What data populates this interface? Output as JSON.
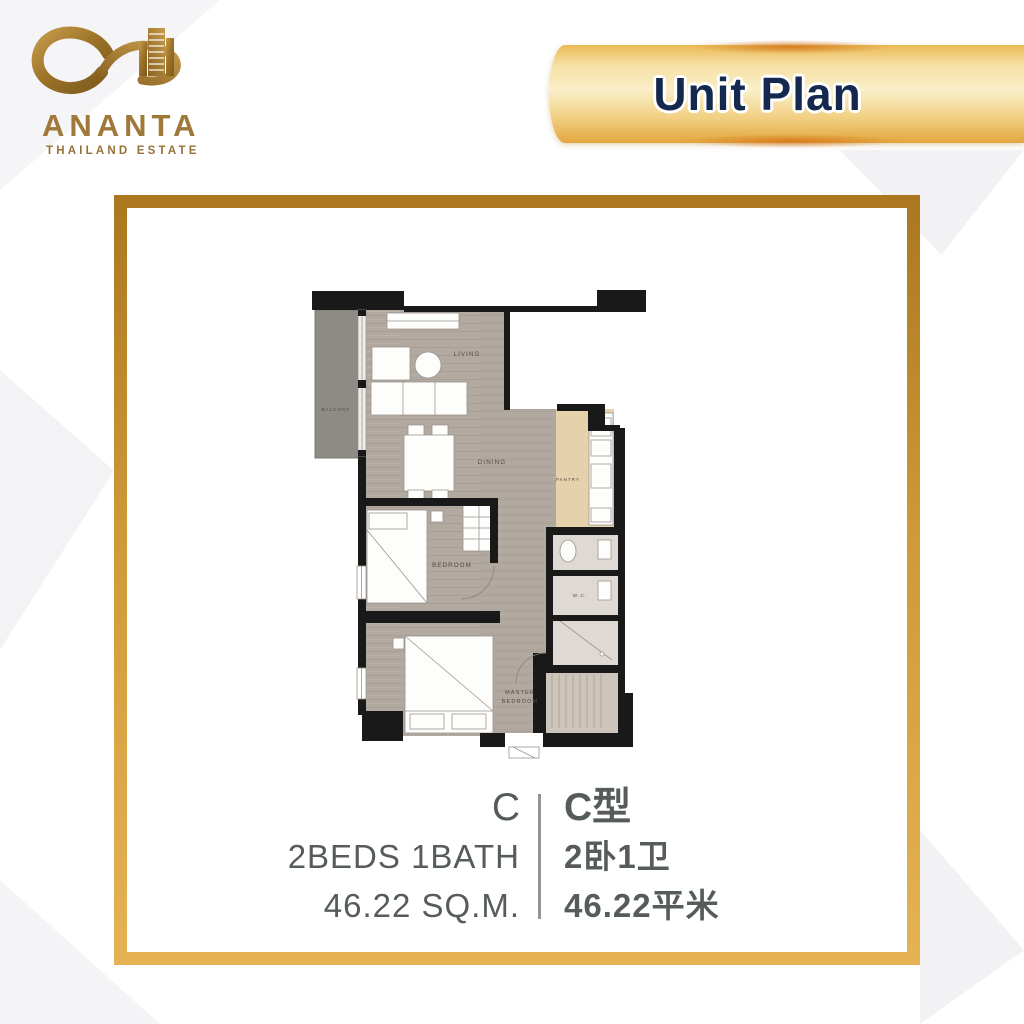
{
  "header": {
    "logo": {
      "brand": "ANANTA",
      "tagline": "THAILAND ESTATE"
    },
    "banner": {
      "title": "Unit Plan"
    }
  },
  "floor_plan": {
    "rooms": {
      "living": "LIVING",
      "dining": "DINING",
      "balcony": "BALCONY",
      "pantry": "PANTRY",
      "bedroom": "BEDROOM",
      "wc": "W.C.",
      "master_line1": "MASTER",
      "master_line2": "BEDROOM"
    }
  },
  "unit_info": {
    "en": {
      "type": "C",
      "beds_bath": "2BEDS 1BATH",
      "area": "46.22 SQ.M."
    },
    "zh": {
      "type": "C型",
      "beds_bath": "2卧1卫",
      "area": "46.22平米"
    }
  },
  "colors": {
    "gold_accent": "#c9952f",
    "banner_gold_light": "#faefc9",
    "title_navy": "#14294d",
    "info_text_gray": "#565d59",
    "wall_black": "#191919",
    "floor_taupe": "#b2a9a0",
    "pantry_tan": "#e5d1aa",
    "balcony_gray": "#8c8c85"
  }
}
